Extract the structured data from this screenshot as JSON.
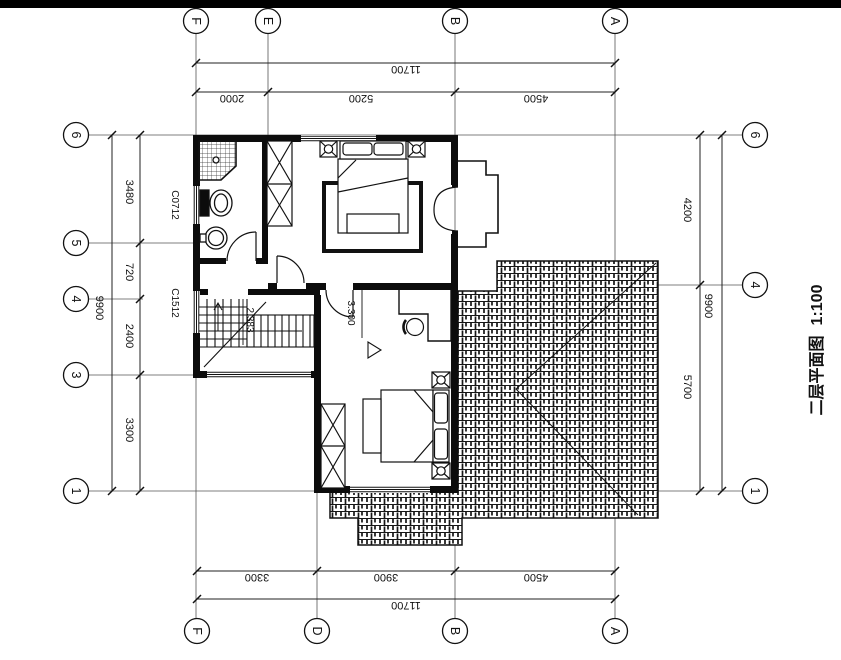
{
  "plan": {
    "title": "二层平面图",
    "scale": "1:100",
    "grid": {
      "top": [
        "F",
        "E",
        "B",
        "A"
      ],
      "bottom": [
        "F",
        "D",
        "B",
        "A"
      ],
      "left": [
        "6",
        "5",
        "4",
        "3",
        "1"
      ],
      "right": [
        "6",
        "4",
        "1"
      ]
    },
    "dims": {
      "top": {
        "total": "11700",
        "segments": [
          "2000",
          "5200",
          "4500"
        ]
      },
      "bottom": {
        "total": "11700",
        "segments": [
          "3300",
          "3900",
          "4500"
        ]
      },
      "left": {
        "total": "9900",
        "segments": [
          "3480",
          "720",
          "2400",
          "3300"
        ]
      },
      "right": {
        "total": "9900",
        "segments": [
          "4200",
          "5700"
        ]
      }
    },
    "windows": {
      "w1": "C0712",
      "w2": "C1512"
    },
    "levels": {
      "stair": "2.383",
      "floor": "3.300"
    },
    "colors": {
      "line": "#111111",
      "wall": "#0c0c0c",
      "paper": "#ffffff"
    }
  }
}
